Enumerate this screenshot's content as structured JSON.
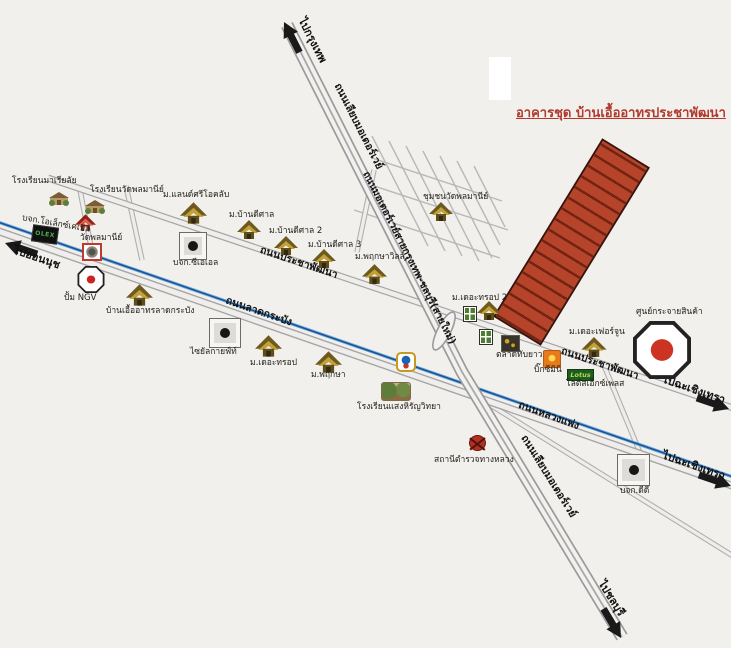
{
  "map": {
    "title": "อาคารชุด บ้านเอื้ออาทรประชาพัฒนา",
    "colors": {
      "background": "#f2f0ec",
      "title_red": "#b03a2e",
      "building_red": "#b5442a",
      "building_stripe": "#732312",
      "canal_blue": "#15508f",
      "road_fill": "#efefef"
    },
    "roads": {
      "motorway_frontage_top": "ถนนเลียบมอเตอร์เวย์",
      "motorway_main": "ถนนมอเตอร์เวย์สายกรุงเทพ-ชลบุรี(สายใหม่)",
      "motorway_frontage_bottom": "ถนนเลียบมอเตอร์เวย์",
      "pracha_phatthana_left": "ถนนประชาพัฒนา",
      "pracha_phatthana_right": "ถนนประชาพัฒนา",
      "lat_krabang": "ถนนลาดกระบัง",
      "luang_phaeng": "ถนนหลวงแพ่ง"
    },
    "directions": {
      "to_bangkok": "ไปกรุงเทพ",
      "to_on_nut": "ไปอ่อนนุช",
      "to_chonburi": "ไปชลบุรี",
      "to_chachoengsao_upper": "ไปฉะเชิงเทรา",
      "to_chachoengsao_lower": "ไปฉะเชิงเทรา"
    },
    "pois": {
      "maria_school": {
        "label": "โรงเรียนมาเรียลัย"
      },
      "wat_phlamani_school": {
        "label": "โรงเรียนวัดพลมานีย์"
      },
      "olex": {
        "label": "บจก.โอเล็กซ์เคเบิล"
      },
      "wat_phlamani": {
        "label": "วัดพลมานีย์"
      },
      "ngv": {
        "label": "ปั้ม NGV"
      },
      "eua_arthorn_lk": {
        "label": "บ้านเอื้ออาทรลาดกระบัง"
      },
      "land_si_o_club": {
        "label": "ม.แลนด์ศรีโอคลับ"
      },
      "cea": {
        "label": "บจก.ซีเอเอล"
      },
      "ban_di_san_1": {
        "label": "ม.บ้านดีศาล"
      },
      "ban_di_san_2": {
        "label": "ม.บ้านดีศาล 2"
      },
      "ban_di_san_3": {
        "label": "ม.บ้านดีศาล 3"
      },
      "phruksa_ville": {
        "label": "ม.พฤกษาวิลล์"
      },
      "chumchon_wat": {
        "label": "ชุมชนวัดพลมานีย์"
      },
      "the_trop_2": {
        "label": "ม.เดอะทรอป 2"
      },
      "talat_thap_yao": {
        "label": "ตลาดทับยาว"
      },
      "big_c_mini": {
        "label": "บิ๊กซีมินิ"
      },
      "lotus_express": {
        "label": "โลตัสเอ็กซ์เพลส"
      },
      "the_fortune": {
        "label": "ม.เดอะเฟอร์จูน"
      },
      "distribution_center": {
        "label": "ศูนย์กระจายสินค้า"
      },
      "the_trop": {
        "label": "ม.เดอะทรอป"
      },
      "phruksa": {
        "label": "ม.พฤกษา"
      },
      "siam_gift": {
        "label": "ไซยัลกายฟ์ท์"
      },
      "saeng_hiran_school": {
        "label": "โรงเรียนแสงหิรัญวิทยา"
      },
      "highway_police": {
        "label": "สถานีตำรวจทางหลวง"
      },
      "dd": {
        "label": "บจก.ดีดี"
      }
    },
    "logos": {
      "olex": "OLEX",
      "lotus": "Lotus"
    }
  }
}
